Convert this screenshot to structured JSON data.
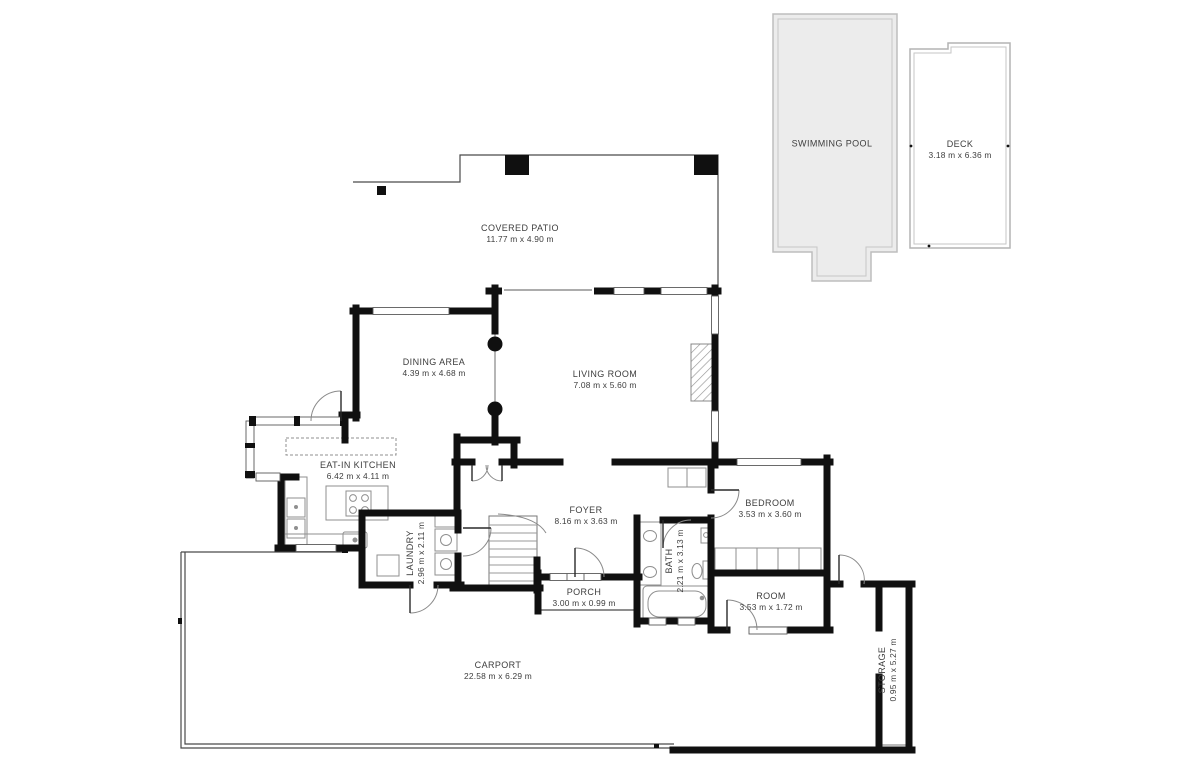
{
  "plan": {
    "colors": {
      "wall": "#101010",
      "thin_line": "#4a4a4a",
      "furniture": "#8f8f8f",
      "pool_fill": "#ececec",
      "pool_border": "#bdbdbd",
      "label_text": "#3d3d3d"
    },
    "rooms": [
      {
        "id": "swimming-pool",
        "name": "SWIMMING POOL",
        "dims": ""
      },
      {
        "id": "deck",
        "name": "DECK",
        "dims": "3.18 m x 6.36 m"
      },
      {
        "id": "covered-patio",
        "name": "COVERED PATIO",
        "dims": "11.77 m x 4.90 m"
      },
      {
        "id": "dining-area",
        "name": "DINING AREA",
        "dims": "4.39 m x 4.68 m"
      },
      {
        "id": "living-room",
        "name": "LIVING ROOM",
        "dims": "7.08 m x 5.60 m"
      },
      {
        "id": "eat-in-kitchen",
        "name": "EAT-IN KITCHEN",
        "dims": "6.42 m x 4.11 m"
      },
      {
        "id": "foyer",
        "name": "FOYER",
        "dims": "8.16 m x 3.63 m"
      },
      {
        "id": "bedroom",
        "name": "BEDROOM",
        "dims": "3.53 m x 3.60 m"
      },
      {
        "id": "laundry",
        "name": "LAUNDRY",
        "dims": "2.96 m x 2.11 m"
      },
      {
        "id": "bath",
        "name": "BATH",
        "dims": "2.21 m x 3.13 m"
      },
      {
        "id": "porch",
        "name": "PORCH",
        "dims": "3.00 m x 0.99 m"
      },
      {
        "id": "room",
        "name": "ROOM",
        "dims": "3.53 m x 1.72 m"
      },
      {
        "id": "carport",
        "name": "CARPORT",
        "dims": "22.58 m x 6.29 m"
      },
      {
        "id": "storage",
        "name": "STORAGE",
        "dims": "0.95 m x 5.27 m"
      }
    ]
  }
}
